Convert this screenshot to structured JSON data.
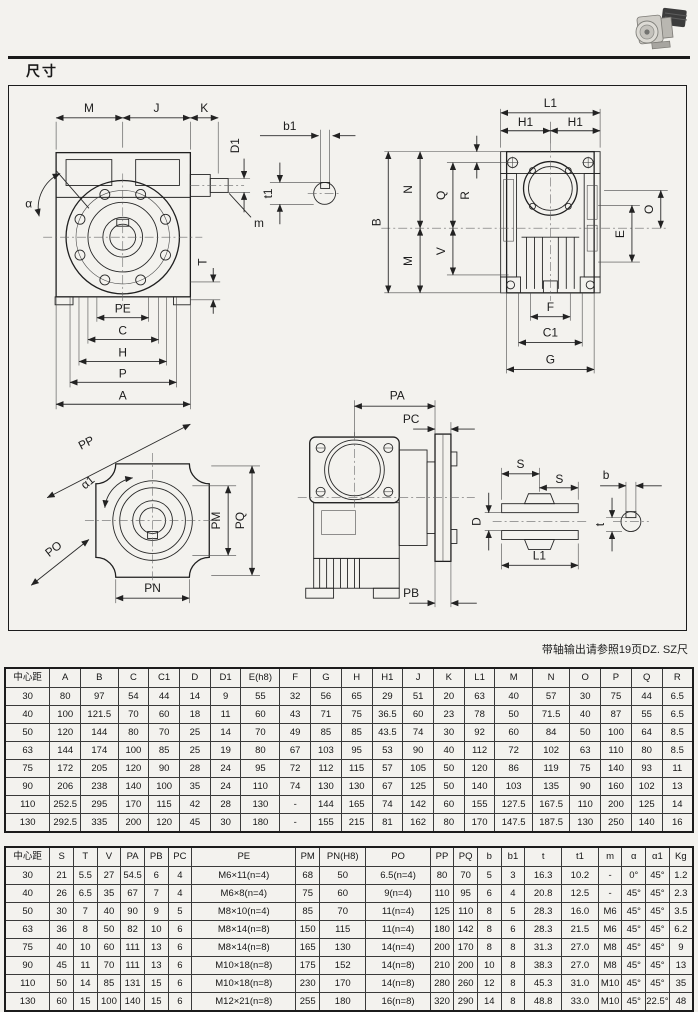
{
  "page": {
    "title": "尺寸",
    "note": "带轴输出请参照19页DZ. SZ尺"
  },
  "dims": {
    "M": "M",
    "J": "J",
    "K": "K",
    "D1": "D1",
    "m": "m",
    "alpha": "α",
    "T": "T",
    "PE": "PE",
    "C": "C",
    "H": "H",
    "P": "P",
    "A": "A",
    "b1": "b1",
    "t1": "t1",
    "L1": "L1",
    "H1": "H1",
    "B": "B",
    "N": "N",
    "Q": "Q",
    "V": "V",
    "R": "R",
    "O": "O",
    "E": "E",
    "F": "F",
    "C1": "C1",
    "G": "G",
    "PP": "PP",
    "alpha1": "α1",
    "PO": "PO",
    "PM": "PM",
    "PQ": "PQ",
    "PN": "PN",
    "PA": "PA",
    "PC": "PC",
    "PB": "PB",
    "S": "S",
    "D": "D",
    "b": "b",
    "t": "t"
  },
  "table1": {
    "headers": [
      "中心距",
      "A",
      "B",
      "C",
      "C1",
      "D",
      "D1",
      "E(h8)",
      "F",
      "G",
      "H",
      "H1",
      "J",
      "K",
      "L1",
      "M",
      "N",
      "O",
      "P",
      "Q",
      "R"
    ],
    "rows": [
      [
        "30",
        "80",
        "97",
        "54",
        "44",
        "14",
        "9",
        "55",
        "32",
        "56",
        "65",
        "29",
        "51",
        "20",
        "63",
        "40",
        "57",
        "30",
        "75",
        "44",
        "6.5"
      ],
      [
        "40",
        "100",
        "121.5",
        "70",
        "60",
        "18",
        "11",
        "60",
        "43",
        "71",
        "75",
        "36.5",
        "60",
        "23",
        "78",
        "50",
        "71.5",
        "40",
        "87",
        "55",
        "6.5"
      ],
      [
        "50",
        "120",
        "144",
        "80",
        "70",
        "25",
        "14",
        "70",
        "49",
        "85",
        "85",
        "43.5",
        "74",
        "30",
        "92",
        "60",
        "84",
        "50",
        "100",
        "64",
        "8.5"
      ],
      [
        "63",
        "144",
        "174",
        "100",
        "85",
        "25",
        "19",
        "80",
        "67",
        "103",
        "95",
        "53",
        "90",
        "40",
        "112",
        "72",
        "102",
        "63",
        "110",
        "80",
        "8.5"
      ],
      [
        "75",
        "172",
        "205",
        "120",
        "90",
        "28",
        "24",
        "95",
        "72",
        "112",
        "115",
        "57",
        "105",
        "50",
        "120",
        "86",
        "119",
        "75",
        "140",
        "93",
        "11"
      ],
      [
        "90",
        "206",
        "238",
        "140",
        "100",
        "35",
        "24",
        "110",
        "74",
        "130",
        "130",
        "67",
        "125",
        "50",
        "140",
        "103",
        "135",
        "90",
        "160",
        "102",
        "13"
      ],
      [
        "110",
        "252.5",
        "295",
        "170",
        "115",
        "42",
        "28",
        "130",
        "-",
        "144",
        "165",
        "74",
        "142",
        "60",
        "155",
        "127.5",
        "167.5",
        "110",
        "200",
        "125",
        "14"
      ],
      [
        "130",
        "292.5",
        "335",
        "200",
        "120",
        "45",
        "30",
        "180",
        "-",
        "155",
        "215",
        "81",
        "162",
        "80",
        "170",
        "147.5",
        "187.5",
        "130",
        "250",
        "140",
        "16"
      ]
    ]
  },
  "table2": {
    "headers": [
      "中心距",
      "S",
      "T",
      "V",
      "PA",
      "PB",
      "PC",
      "PE",
      "PM",
      "PN(H8)",
      "PO",
      "PP",
      "PQ",
      "b",
      "b1",
      "t",
      "t1",
      "m",
      "α",
      "α1",
      "Kg"
    ],
    "rows": [
      [
        "30",
        "21",
        "5.5",
        "27",
        "54.5",
        "6",
        "4",
        "M6×11(n=4)",
        "68",
        "50",
        "6.5(n=4)",
        "80",
        "70",
        "5",
        "3",
        "16.3",
        "10.2",
        "-",
        "0°",
        "45°",
        "1.2"
      ],
      [
        "40",
        "26",
        "6.5",
        "35",
        "67",
        "7",
        "4",
        "M6×8(n=4)",
        "75",
        "60",
        "9(n=4)",
        "110",
        "95",
        "6",
        "4",
        "20.8",
        "12.5",
        "-",
        "45°",
        "45°",
        "2.3"
      ],
      [
        "50",
        "30",
        "7",
        "40",
        "90",
        "9",
        "5",
        "M8×10(n=4)",
        "85",
        "70",
        "11(n=4)",
        "125",
        "110",
        "8",
        "5",
        "28.3",
        "16.0",
        "M6",
        "45°",
        "45°",
        "3.5"
      ],
      [
        "63",
        "36",
        "8",
        "50",
        "82",
        "10",
        "6",
        "M8×14(n=8)",
        "150",
        "115",
        "11(n=4)",
        "180",
        "142",
        "8",
        "6",
        "28.3",
        "21.5",
        "M6",
        "45°",
        "45°",
        "6.2"
      ],
      [
        "75",
        "40",
        "10",
        "60",
        "111",
        "13",
        "6",
        "M8×14(n=8)",
        "165",
        "130",
        "14(n=4)",
        "200",
        "170",
        "8",
        "8",
        "31.3",
        "27.0",
        "M8",
        "45°",
        "45°",
        "9"
      ],
      [
        "90",
        "45",
        "11",
        "70",
        "111",
        "13",
        "6",
        "M10×18(n=8)",
        "175",
        "152",
        "14(n=8)",
        "210",
        "200",
        "10",
        "8",
        "38.3",
        "27.0",
        "M8",
        "45°",
        "45°",
        "13"
      ],
      [
        "110",
        "50",
        "14",
        "85",
        "131",
        "15",
        "6",
        "M10×18(n=8)",
        "230",
        "170",
        "14(n=8)",
        "280",
        "260",
        "12",
        "8",
        "45.3",
        "31.0",
        "M10",
        "45°",
        "45°",
        "35"
      ],
      [
        "130",
        "60",
        "15",
        "100",
        "140",
        "15",
        "6",
        "M12×21(n=8)",
        "255",
        "180",
        "16(n=8)",
        "320",
        "290",
        "14",
        "8",
        "48.8",
        "33.0",
        "M10",
        "45°",
        "22.5°",
        "48"
      ]
    ]
  }
}
